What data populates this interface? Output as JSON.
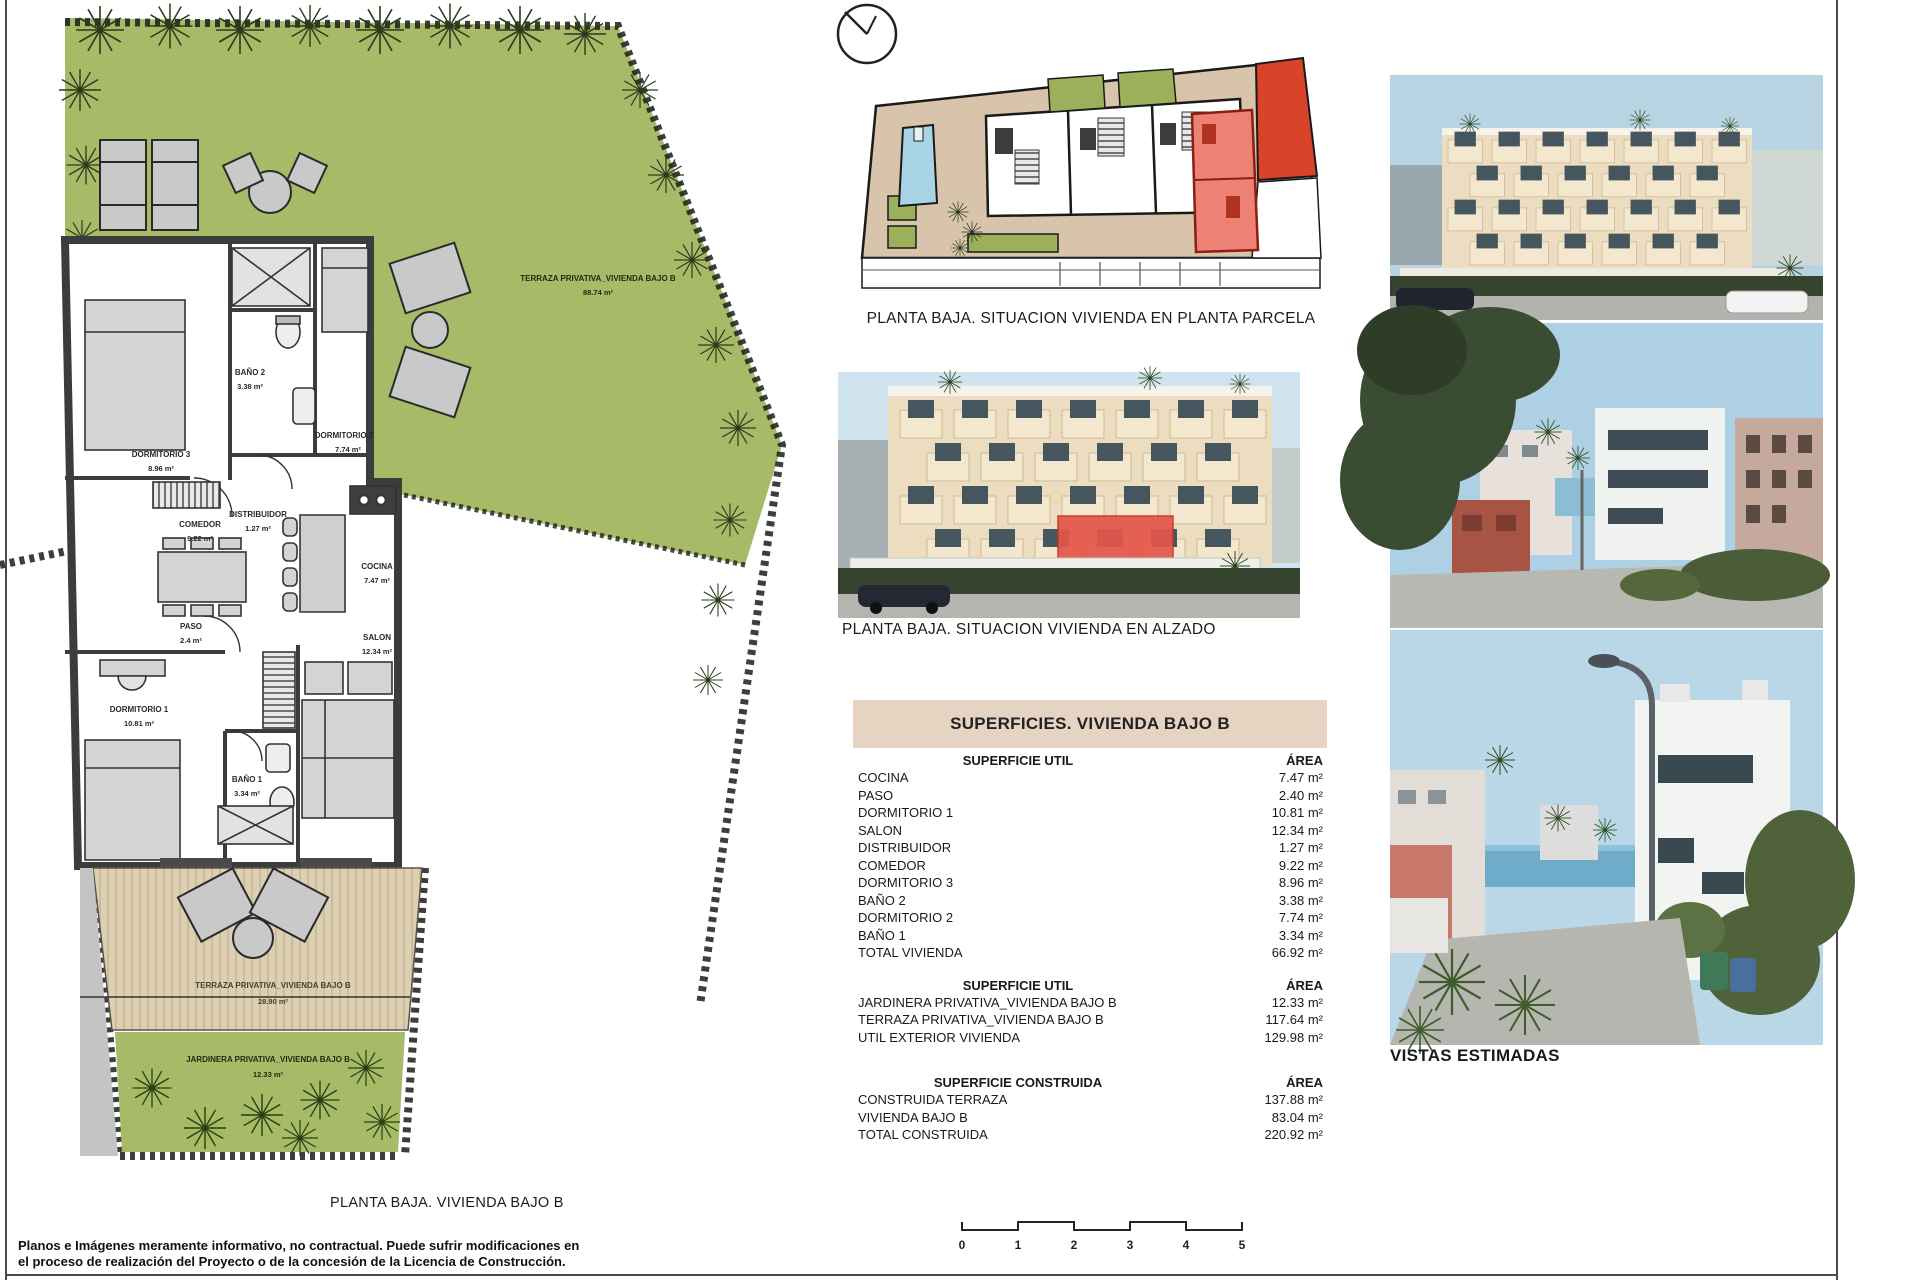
{
  "page": {
    "siteplan_caption": "PLANTA BAJA. SITUACION VIVIENDA EN PLANTA PARCELA",
    "elevation_caption": "PLANTA BAJA. SITUACION VIVIENDA EN ALZADO",
    "plan_caption": "PLANTA BAJA. VIVIENDA BAJO B",
    "photos_caption": "VISTAS ESTIMADAS",
    "disclaimer_line1": "Planos e Imágenes meramente informativo, no contractual. Puede sufrir modificaciones en",
    "disclaimer_line2": "el proceso de realización del Proyecto o de la concesión de la Licencia de Construcción."
  },
  "plan": {
    "garden_label": "TERRAZA PRIVATIVA_VIVIENDA BAJO B",
    "garden_area": "88.74 m²",
    "terrace_label": "TERRAZA PRIVATIVA_VIVIENDA BAJO B",
    "terrace_area": "28.90 m²",
    "jardinera_label": "JARDINERA PRIVATIVA_VIVIENDA BAJO B",
    "jardinera_area": "12.33 m²",
    "rooms": [
      {
        "name": "DORMITORIO 3",
        "area": "8.96 m²"
      },
      {
        "name": "BAÑO 2",
        "area": "3.38 m²"
      },
      {
        "name": "DISTRIBUIDOR",
        "area": "1.27 m²"
      },
      {
        "name": "DORMITORIO 2",
        "area": "7.74 m²"
      },
      {
        "name": "COMEDOR",
        "area": "9.22 m²"
      },
      {
        "name": "COCINA",
        "area": "7.47 m²"
      },
      {
        "name": "PASO",
        "area": "2.4 m²"
      },
      {
        "name": "SALON",
        "area": "12.34 m²"
      },
      {
        "name": "DORMITORIO 1",
        "area": "10.81 m²"
      },
      {
        "name": "BAÑO 1",
        "area": "3.34 m²"
      }
    ]
  },
  "table": {
    "title": "SUPERFICIES. VIVIENDA BAJO B",
    "sections": [
      {
        "header": "SUPERFICIE UTIL",
        "area_header": "ÁREA",
        "rows": [
          [
            "COCINA",
            "7.47 m²"
          ],
          [
            "PASO",
            "2.40 m²"
          ],
          [
            "DORMITORIO 1",
            "10.81 m²"
          ],
          [
            "SALON",
            "12.34 m²"
          ],
          [
            "DISTRIBUIDOR",
            "1.27 m²"
          ],
          [
            "COMEDOR",
            "9.22 m²"
          ],
          [
            "DORMITORIO 3",
            "8.96 m²"
          ],
          [
            "BAÑO 2",
            "3.38 m²"
          ],
          [
            "DORMITORIO 2",
            "7.74 m²"
          ],
          [
            "BAÑO 1",
            "3.34 m²"
          ],
          [
            "TOTAL VIVIENDA",
            "66.92 m²"
          ]
        ]
      },
      {
        "header": "SUPERFICIE UTIL",
        "area_header": "ÁREA",
        "rows": [
          [
            "JARDINERA PRIVATIVA_VIVIENDA BAJO B",
            "12.33 m²"
          ],
          [
            "TERRAZA PRIVATIVA_VIVIENDA BAJO B",
            "117.64 m²"
          ],
          [
            "UTIL EXTERIOR VIVIENDA",
            "129.98 m²"
          ]
        ]
      },
      {
        "header": "SUPERFICIE CONSTRUIDA",
        "area_header": "ÁREA",
        "rows": [
          [
            "CONSTRUIDA TERRAZA",
            "137.88 m²"
          ],
          [
            "VIVIENDA BAJO B",
            "83.04 m²"
          ],
          [
            "TOTAL CONSTRUIDA",
            "220.92 m²"
          ]
        ]
      }
    ]
  },
  "scalebar": {
    "labels": [
      "0",
      "1",
      "2",
      "3",
      "4",
      "5"
    ]
  },
  "colors": {
    "garden_green": "#a6ba67",
    "terrace_tan": "#ddd0b2",
    "wall_gray": "#3c3c3c",
    "site_beige": "#d8c3ab",
    "site_green": "#9cb05c",
    "pool_blue": "#a9d4e6",
    "unit_red": "#d8432a",
    "unit_pink": "#ee8176",
    "table_band": "#e6d4c2"
  }
}
